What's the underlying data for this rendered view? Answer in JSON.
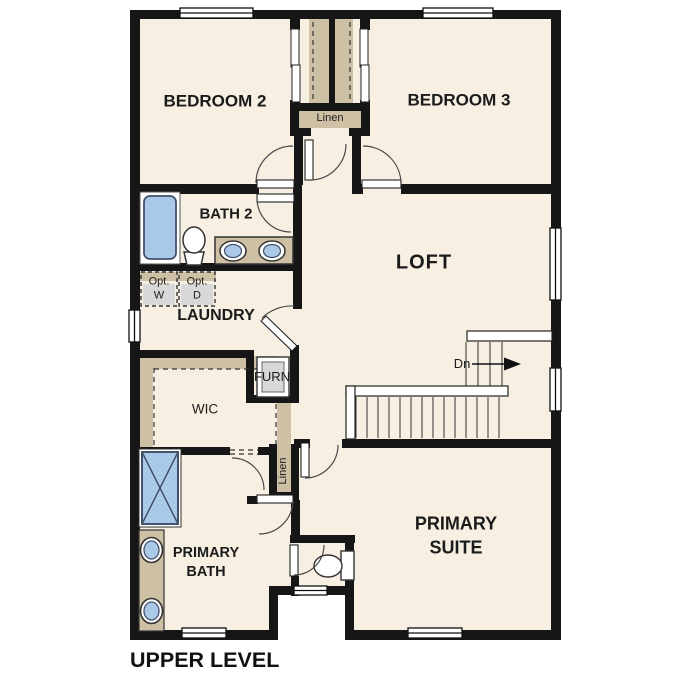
{
  "title": "UPPER LEVEL",
  "colors": {
    "floor": "#f6efe2",
    "wall": "#161616",
    "tan": "#cec0a5",
    "blue": "#aac9e8",
    "gray": "#d8d8d8"
  },
  "rooms": {
    "bedroom2": "BEDROOM 2",
    "bedroom3": "BEDROOM 3",
    "bath2": "BATH 2",
    "laundry": "LAUNDRY",
    "loft": "LOFT",
    "wic": "WIC",
    "furnace": "FURN",
    "linen_upper": "Linen",
    "linen_lower": "Linen",
    "primary_suite_line1": "PRIMARY",
    "primary_suite_line2": "SUITE",
    "primary_bath_line1": "PRIMARY",
    "primary_bath_line2": "BATH"
  },
  "appliances": {
    "washer_line1": "Opt.",
    "washer_line2": "W",
    "dryer_line1": "Opt.",
    "dryer_line2": "D"
  },
  "stairs": {
    "down_label": "Dn"
  }
}
